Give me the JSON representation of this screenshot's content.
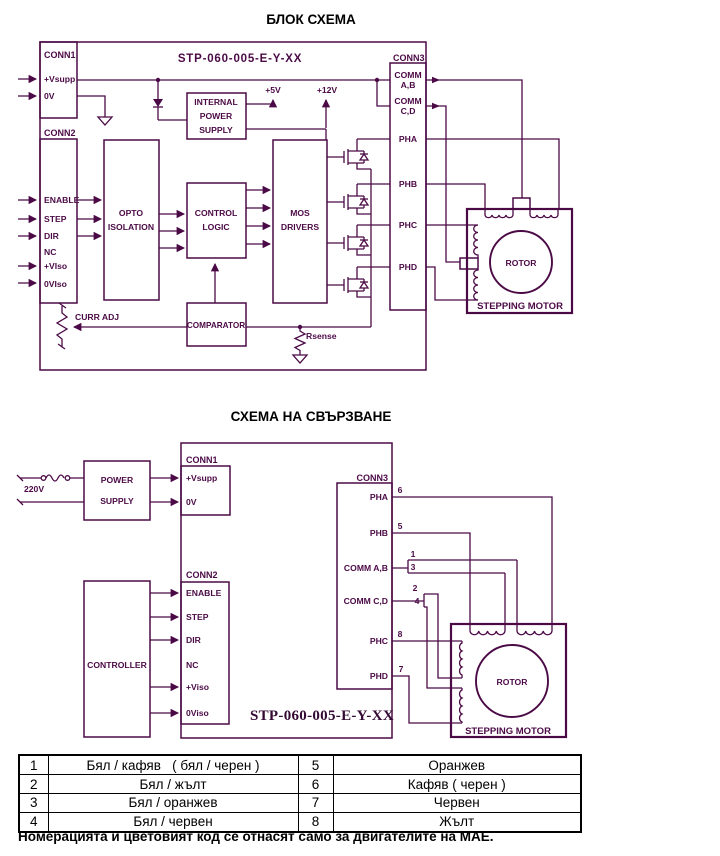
{
  "colors": {
    "ink": "#4b0a46",
    "text": "#000000"
  },
  "block": {
    "title": "БЛОК СХЕМА",
    "model": "STP-060-005-E-Y-XX",
    "conn1": {
      "label": "CONN1",
      "pin1": "+Vsupp",
      "pin2": "0V"
    },
    "conn2": {
      "label": "CONN2",
      "pins": [
        "ENABLE",
        "STEP",
        "DIR",
        "NC",
        "+VIso",
        "0VIso"
      ]
    },
    "conn3": {
      "label": "CONN3",
      "comm_ab": [
        "COMM",
        "A,B"
      ],
      "comm_cd": [
        "COMM",
        "C,D"
      ],
      "phases": [
        "PHA",
        "PHB",
        "PHC",
        "PHD"
      ]
    },
    "internal_ps": [
      "INTERNAL",
      "POWER",
      "SUPPLY"
    ],
    "opto": [
      "OPTO",
      "ISOLATION"
    ],
    "control": [
      "CONTROL",
      "LOGIC"
    ],
    "mos": [
      "MOS",
      "DRIVERS"
    ],
    "comparator": "COMPARATOR",
    "v5": "+5V",
    "v12": "+12V",
    "curr_adj": "CURR ADJ",
    "rsense": "Rsense",
    "rotor": "ROTOR",
    "motor": "STEPPING MOTOR"
  },
  "wiring": {
    "title": "СХЕМА НА СВЪРЗВАНЕ",
    "model": "STP-060-005-E-Y-XX",
    "mains": "220V",
    "power_supply": [
      "POWER",
      "SUPPLY"
    ],
    "controller": "CONTROLLER",
    "conn1": {
      "label": "CONN1",
      "pin1": "+Vsupp",
      "pin2": "0V"
    },
    "conn2": {
      "label": "CONN2",
      "pins": [
        "ENABLE",
        "STEP",
        "DIR",
        "NC",
        "+Viso",
        "0Viso"
      ]
    },
    "conn3": {
      "label": "CONN3",
      "pins": [
        "PHA",
        "PHB",
        "COMM A,B",
        "COMM C,D",
        "PHC",
        "PHD"
      ]
    },
    "wires": {
      "pha": "6",
      "phb": "5",
      "comm_ab_1": "1",
      "comm_ab_3": "3",
      "comm_cd_2": "2",
      "comm_cd_4": "4",
      "phc": "8",
      "phd": "7"
    },
    "rotor": "ROTOR",
    "motor": "STEPPING MOTOR"
  },
  "table": {
    "rows": [
      [
        "1",
        "Бял / кафяв   ( бял / черен )",
        "5",
        "Оранжев"
      ],
      [
        "2",
        "Бял / жълт",
        "6",
        "Кафяв ( черен )"
      ],
      [
        "3",
        "Бял / оранжев",
        "7",
        "Червен"
      ],
      [
        "4",
        "Бял / червен",
        "8",
        "Жълт"
      ]
    ]
  },
  "note": "Номерацията и цветовият код се отнасят само за двигателите на МАЕ."
}
